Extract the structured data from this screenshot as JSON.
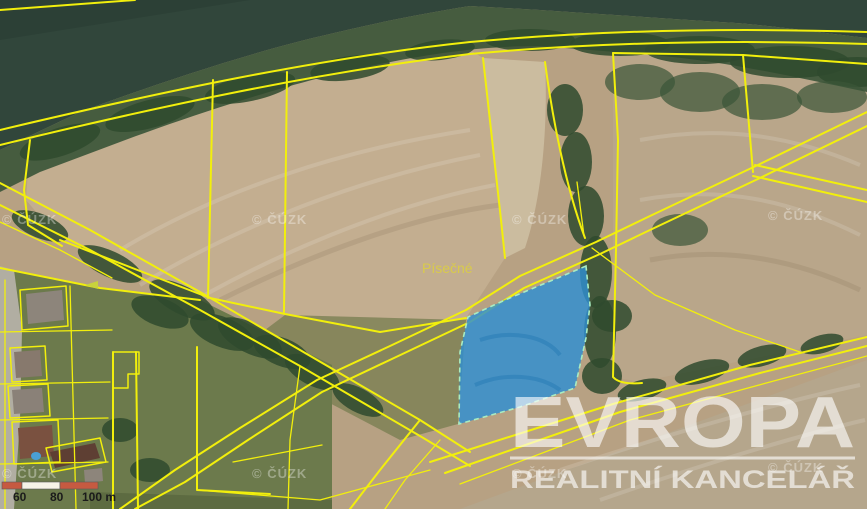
{
  "map": {
    "place_label": "Písečné",
    "copyright_watermark": "© ČÚZK"
  },
  "logo": {
    "title": "EVROPA",
    "subtitle": "REALITNÍ KANCELÁŘ"
  },
  "scalebar": {
    "labels": [
      "60",
      "80",
      "100 m"
    ]
  },
  "colors": {
    "cadastral_line": "#f2ef0c",
    "highlight_parcel_fill": "#2e8fd2",
    "highlight_parcel_border": "#a9ecc2",
    "water": "#31463b",
    "field": "#b7a183",
    "scalebar_red": "#c65a41",
    "logo_white": "#ffffff"
  }
}
